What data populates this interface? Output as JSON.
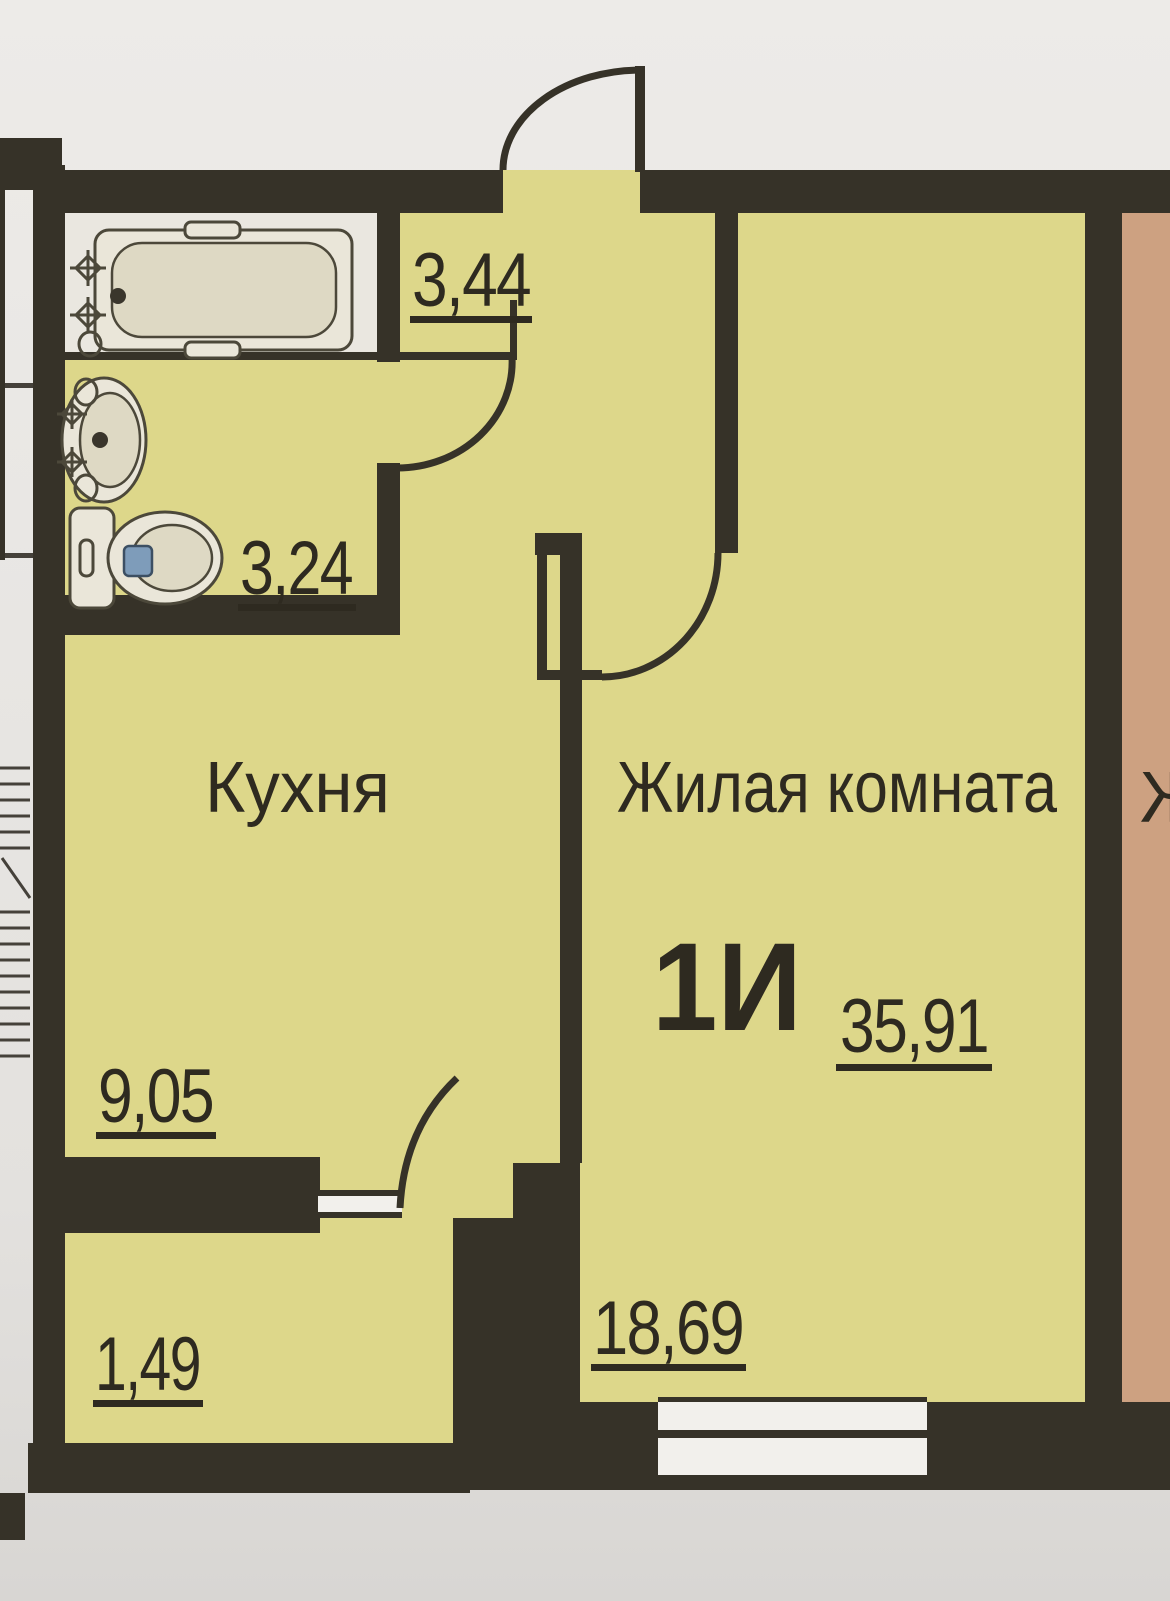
{
  "plan": {
    "title": "Floor plan of one-room apartment",
    "rooms": {
      "bathroom": {
        "area": "3,44"
      },
      "wc": {
        "area": "3,24"
      },
      "kitchen": {
        "label": "Кухня",
        "area": "9,05"
      },
      "hallway": {
        "area": "1,49"
      },
      "living": {
        "label": "Жилая комната",
        "area": "18,69",
        "apartment_type": "1И",
        "total_area": "35,91"
      }
    },
    "neighbor": {
      "label_partial": "Ж"
    }
  },
  "icons": [
    "bathtub-icon",
    "sink-icon",
    "toilet-icon",
    "stairs-icon",
    "door-swing-icon",
    "window-icon"
  ],
  "colors": {
    "wall": "#363228",
    "floor-yellow": "#ddd78a",
    "floor-peach": "#cda181",
    "floor-bath": "#eae7e0",
    "paper": "#e8e6e3",
    "ink": "#2e2a20",
    "flush-button": "#7e9cba"
  }
}
